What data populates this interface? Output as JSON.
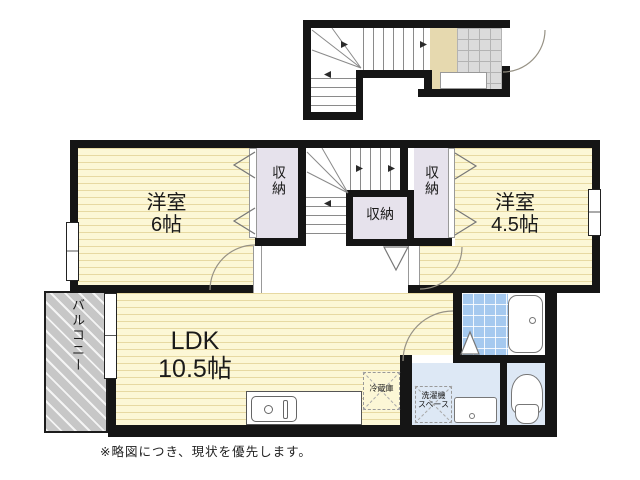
{
  "rooms": {
    "western6": {
      "line1": "洋室",
      "line2": "6帖"
    },
    "western45": {
      "line1": "洋室",
      "line2": "4.5帖"
    },
    "ldk": {
      "line1": "LDK",
      "line2": "10.5帖"
    },
    "closet_left": {
      "label": "収納"
    },
    "closet_center": {
      "label": "収納"
    },
    "closet_right": {
      "label": "収納"
    },
    "balcony": {
      "label": "バルコニー"
    }
  },
  "fixtures": {
    "fridge": {
      "label": "冷蔵庫"
    },
    "laundry": {
      "line1": "洗濯機",
      "line2": "スペース"
    }
  },
  "note": {
    "text": "※略図につき、現状を優先します。"
  },
  "colors": {
    "wall": "#151515",
    "room_yellow": "#fcf7d6",
    "closet_lavender": "#e6e2ec",
    "entrance_beige": "#e6d9af",
    "tile_gray": "#dbdbdb",
    "bath_tile_blue": "#a5c9ef",
    "wet_room_blue": "#dde8f5",
    "balcony_gray": "#c7c7c7"
  }
}
